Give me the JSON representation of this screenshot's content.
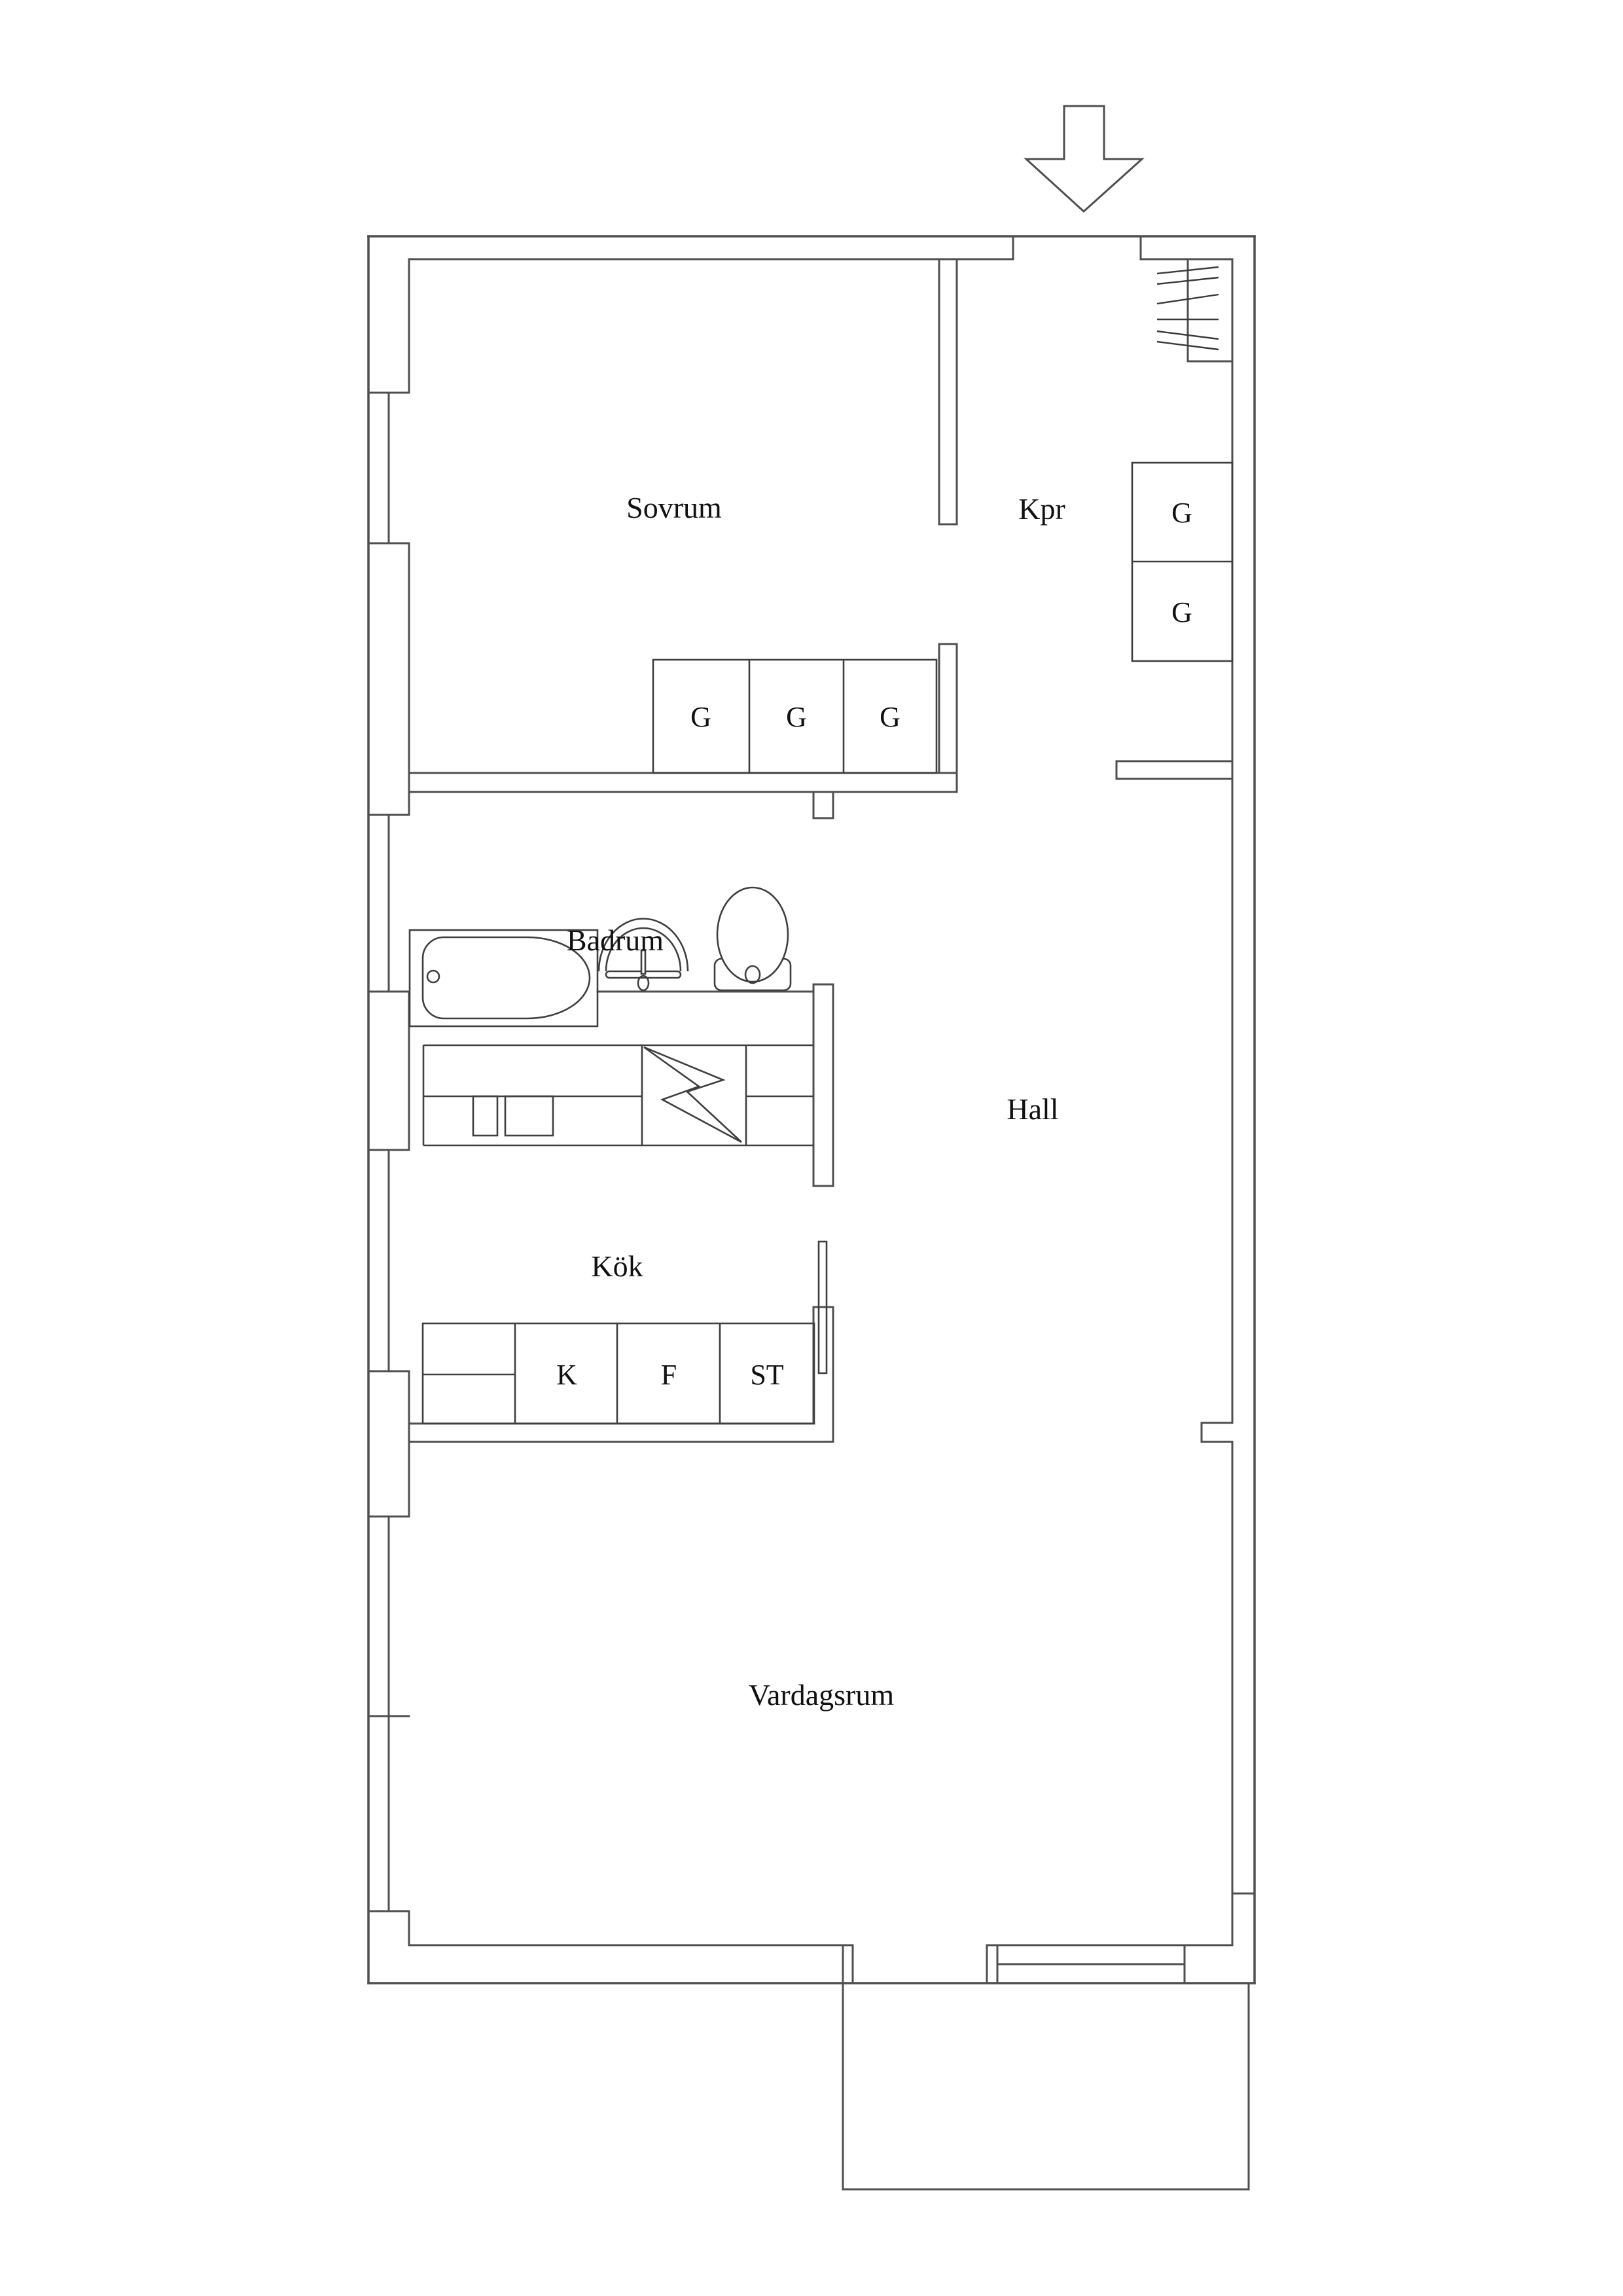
{
  "document": {
    "type": "apartment-floor-plan",
    "background": "#ffffff"
  },
  "colors": {
    "wall_line": "#4f4f4f",
    "fixture_line": "#3f3f3f",
    "label_text": "#111111"
  },
  "rooms": {
    "sovrum": {
      "label": "Sovrum"
    },
    "kpr": {
      "label": "Kpr"
    },
    "badrum": {
      "label": "Badrum"
    },
    "hall": {
      "label": "Hall"
    },
    "kok": {
      "label": "Kök"
    },
    "vardagsrum": {
      "label": "Vardagsrum"
    }
  },
  "closets": {
    "bedroom": [
      "G",
      "G",
      "G"
    ],
    "hall": [
      "G",
      "G"
    ]
  },
  "appliances": {
    "kyl": "K",
    "frys": "F",
    "stad": "ST"
  },
  "icons": {
    "entrance-arrow-icon": "outlined down-arrow marking entry",
    "hanging-rail-icon": "closet rail with diagonal hatch strokes",
    "bathtub-icon": "rounded tub in platform",
    "sink-icon": "arched basin with faucet and drain",
    "toilet-icon": "oval bowl with cistern box",
    "lightning-icon": "electrical bolt symbol in kitchen cabinet",
    "door-leaf-icon": "thin open door leaf rectangle"
  }
}
